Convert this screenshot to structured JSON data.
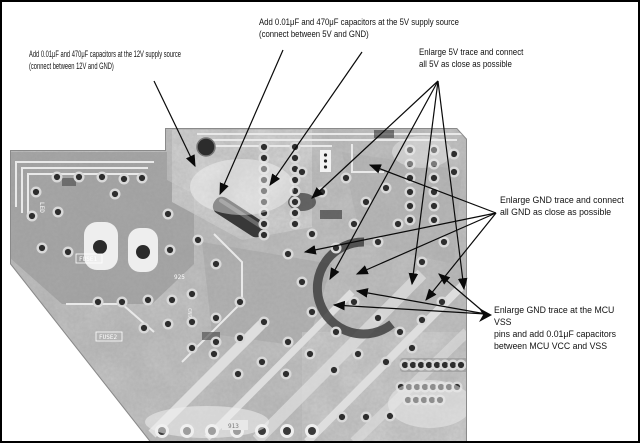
{
  "figure": {
    "type": "annotated-pcb-photo",
    "background": "#ffffff",
    "border_color": "#000000",
    "annotation_text_color": "#111111",
    "arrow_color": "#0a0a0a"
  },
  "annotations": {
    "cap_12v": {
      "text": "Add 0.01μF and 470μF capacitors at the 12V supply source\n(connect between 12V and GND)"
    },
    "cap_5v": {
      "text": "Add 0.01μF and 470μF capacitors at the 5V supply source\n(connect between 5V and GND)"
    },
    "enlarge_5v": {
      "text": "Enlarge 5V trace and connect\nall 5V as close as possible"
    },
    "enlarge_gnd": {
      "text": "Enlarge GND trace and connect\nall GND as close as possible"
    },
    "mcu_vss": {
      "text": "Enlarge GND trace at the MCU VSS\npins and add 0.01μF capacitors\nbetween MCU VCC and VSS"
    }
  },
  "board": {
    "silkscreen": {
      "fuse1": "FUSE1",
      "fuse2": "FUSE2",
      "r913": "913",
      "r925": "925",
      "led": "LED",
      "cn9": "CN9"
    }
  }
}
